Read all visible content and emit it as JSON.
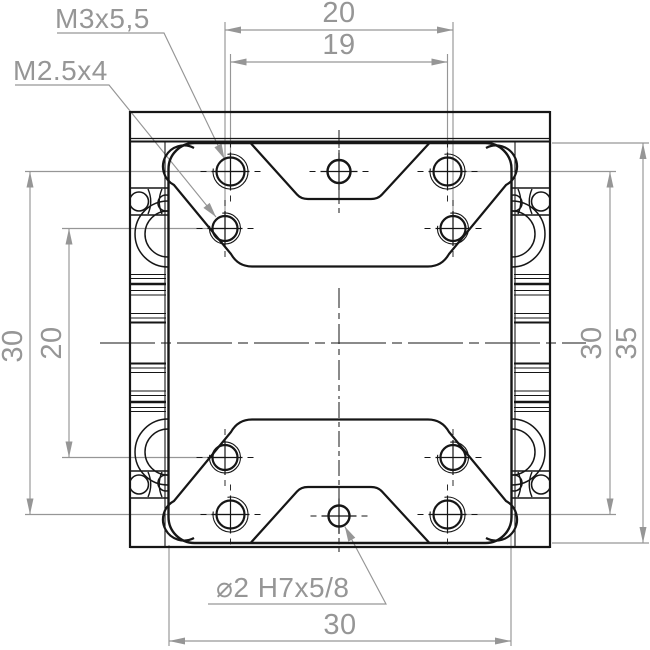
{
  "drawing": {
    "callouts": {
      "thread_top": "M3x5,5",
      "thread_front": "M2.5x4",
      "dowel": "⌀2 H7x5/8"
    },
    "dimensions": {
      "top_outer": "20",
      "top_inner": "19",
      "left_outer": "30",
      "left_inner": "20",
      "right_inner": "30",
      "right_outer": "35",
      "bottom": "30"
    },
    "colors": {
      "line": "#161616",
      "dimension": "#969696",
      "background": "#ffffff"
    }
  }
}
